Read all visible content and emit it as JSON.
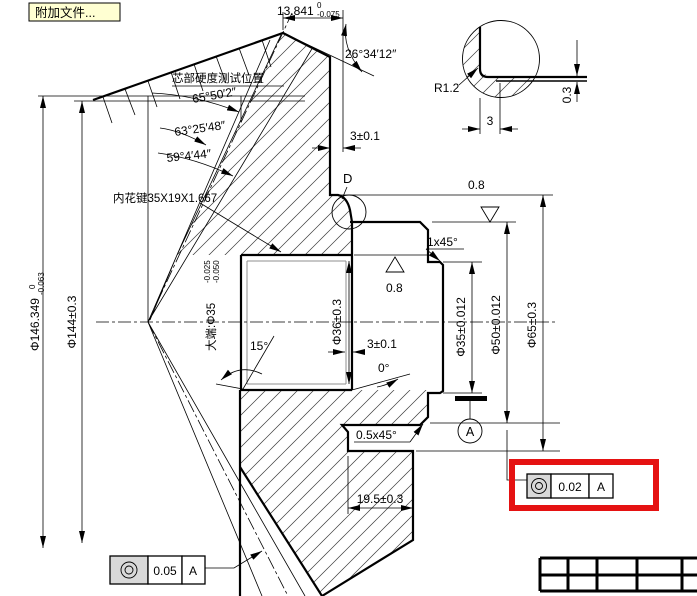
{
  "colors": {
    "accent_red": "#e51212",
    "button_bg": "#ffffd2",
    "symbol_cell_bg": "#d9d9d9",
    "line": "#000000"
  },
  "toolbar": {
    "attach_button_label": "附加文件..."
  },
  "annotations": {
    "core_hardness_label": "芯部硬度测试位置",
    "spline_label": "内花键35X19X1.667",
    "detail_label": "D",
    "datum_label": "A"
  },
  "angles": {
    "back_angle": "26°34′12″",
    "face_cone": "65°50′2″",
    "pitch_cone": "63°25′48″",
    "root_cone": "59°4′44″",
    "spline_taper": "15°",
    "spline_end": "0°"
  },
  "dimensions": {
    "mounting_distance": {
      "value": "13.841",
      "upper": "0",
      "lower": "-0.075"
    },
    "outer_diameter": {
      "value": "Φ146.349",
      "upper": "0",
      "lower": "-0.063"
    },
    "back_diameter": "Φ144±0.3",
    "bore_big_end": {
      "label": "大端:Φ35",
      "upper": "-0.025",
      "lower": "-0.050"
    },
    "spline_od": "Φ36±0.3",
    "rim_width": "3±0.1",
    "groove_width": "3±0.1",
    "journal_diameter": "Φ35±0.012",
    "hub_diameter": "Φ50±0.012",
    "flange_diameter": "Φ65±0.3",
    "hub_length": "19.5±0.3",
    "hub_chamfer": "1x45°",
    "lower_chamfer": "0.5x45°",
    "detail_radius": "R1.2",
    "detail_width": "3",
    "detail_step": "0.3",
    "roughness_hub_face": "0.8",
    "roughness_bore_face": "0.8"
  },
  "geo_tolerances": {
    "highlighted": {
      "symbol": "concentricity",
      "value": "0.02",
      "datum": "A"
    },
    "pitch_runout": {
      "symbol": "concentricity",
      "value": "0.05",
      "datum": "A"
    }
  }
}
